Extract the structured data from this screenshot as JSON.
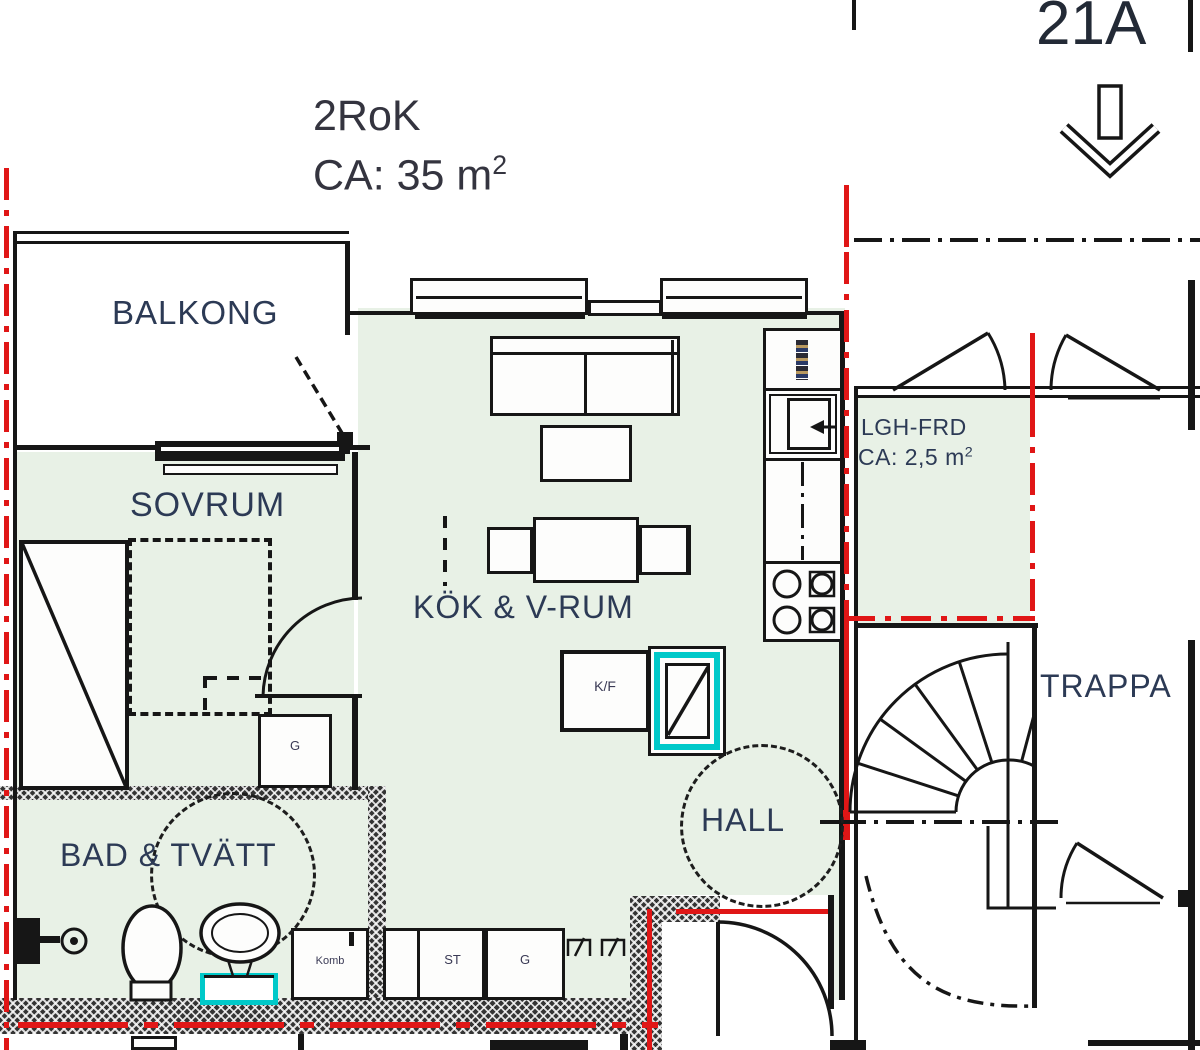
{
  "header": {
    "title_line1": "2RoK",
    "title_line2": "CA: 35 m",
    "title_sup": "2",
    "unit_label": "21A"
  },
  "rooms": {
    "balkong": "BALKONG",
    "sovrum": "SOVRUM",
    "kok_vrum": "KÖK & V-RUM",
    "bad_tvatt": "BAD & TVÄTT",
    "hall": "HALL",
    "trappa": "TRAPPA",
    "lgh_frd": "LGH-FRD",
    "lgh_frd_area": "CA: 2,5 m",
    "lgh_frd_sup": "2"
  },
  "labels": {
    "kf": "K/F",
    "g_bedroom": "G",
    "komb": "Komb",
    "st": "ST",
    "g_hall": "G"
  },
  "colors": {
    "floor_green": "#e8f1e6",
    "wall_black": "#161616",
    "boundary_red": "#e01616",
    "shaft_cyan": "#00c9c9",
    "label_blue": "#2c3a55"
  }
}
